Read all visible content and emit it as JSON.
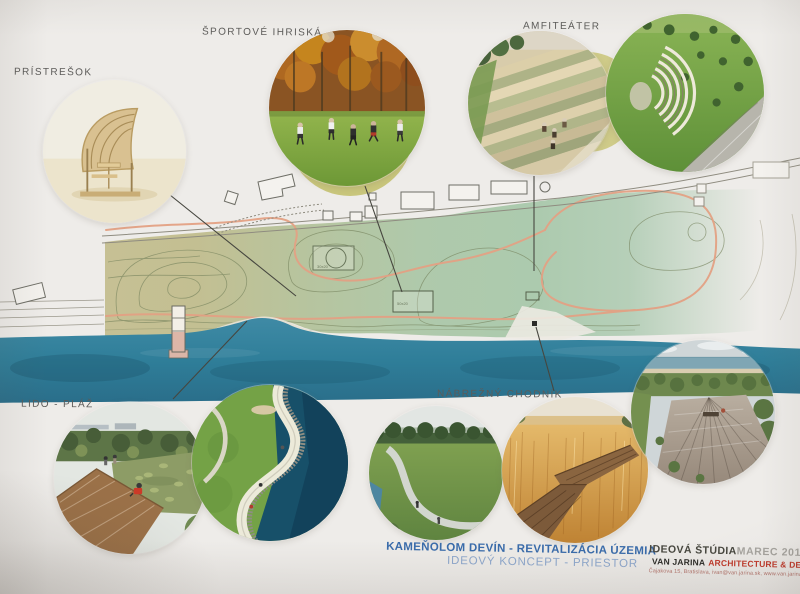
{
  "colors": {
    "board_background": "#eeece9",
    "title_blue": "#3a6cab",
    "subtitle_blue": "#8ea8cd",
    "accent_red": "#c23a2b",
    "river_blue": "#2f7e99",
    "land_green": "#aecaae",
    "land_olive": "#c6c094",
    "path_orange": "#e3a184"
  },
  "callouts": [
    {
      "id": "pristresok",
      "label": "PRÍSTREŠOK"
    },
    {
      "id": "sportove-ihriska",
      "label": "ŠPORTOVÉ IHRISKÁ"
    },
    {
      "id": "amfiteater",
      "label": "AMFITEÁTER"
    },
    {
      "id": "lido-plaz",
      "label": "LIDO - PLÁŽ"
    },
    {
      "id": "nabrezny-chodnik",
      "label": "NÁBREŽNÝ CHODNÍK"
    }
  ],
  "title": {
    "main": "KAMEŇOLOM DEVÍN - REVITALIZÁCIA ÚZEMIA",
    "sub": "IDEOVÝ KONCEPT - PRIESTOR"
  },
  "credits": {
    "study_type": "IDEOVÁ ŠTÚDIA",
    "date": "MAREC 2018",
    "firm": "VAN JARINA",
    "firm_tagline": "ARCHITECTURE & DESIGN",
    "contact": "Čajakova 15, Bratislava, ivan@van.jarina.sk, www.van.jarina.sk"
  },
  "plan": {
    "dim_labels": [
      "30x20",
      "50x20"
    ]
  },
  "photos": [
    {
      "id": "shelter",
      "alt": "curved wooden picnic shelter"
    },
    {
      "id": "sports-fields",
      "alt": "football players on a lawn among autumn trees"
    },
    {
      "id": "amphitheatre-steps",
      "alt": "terraced amphitheatre steps with people"
    },
    {
      "id": "amphitheatre-lawn",
      "alt": "curved lawn amphitheatre with paved plaza"
    },
    {
      "id": "lido-boardwalk",
      "alt": "boardwalk beside a planted pond"
    },
    {
      "id": "lido-promenade",
      "alt": "curved waterfront promenade with rocky shore"
    },
    {
      "id": "riverside-path",
      "alt": "grassy riverside path"
    },
    {
      "id": "reed-boardwalk",
      "alt": "wooden boardwalk through golden reeds"
    },
    {
      "id": "wooden-deck",
      "alt": "wooden deck terrace by the beach"
    }
  ]
}
